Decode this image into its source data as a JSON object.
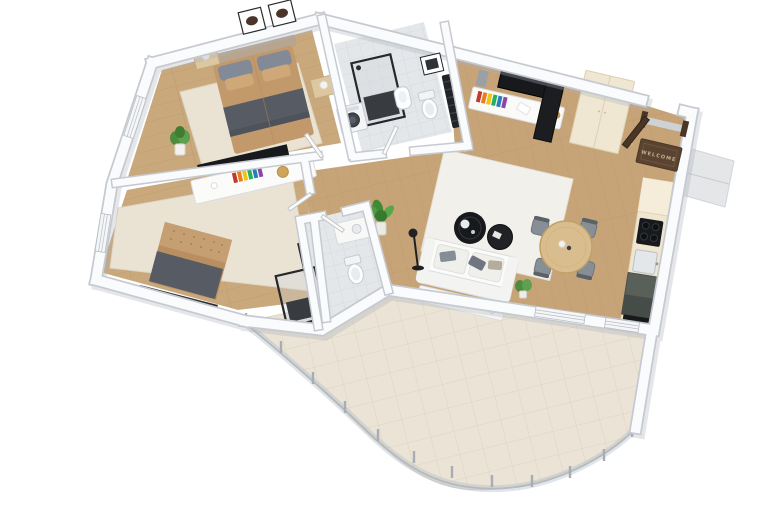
{
  "image": {
    "type": "3d-floor-plan-rendering",
    "view": "isometric top-down",
    "background": "#ffffff"
  },
  "palette": {
    "wood": "#c9a87c",
    "wood_living": "#c7a478",
    "wall": "#fafbfc",
    "wall_edge": "#c6cad0",
    "tile_bath": "#e4e7e9",
    "tile_terrace": "#ebe4d6",
    "rug": "#eae3d4",
    "bed_tan": "#c2996b",
    "blanket": "#565b64",
    "kitchen_dark": "#59605a",
    "cabinet_cream": "#efe7d2",
    "door_brown": "#4a3627",
    "plant": "#4f9c42",
    "black": "#17191c"
  },
  "entry": {
    "doormat_text": "WELCOME",
    "door": "dark-brown-entry-door-open",
    "landing": "exterior-step-landing"
  },
  "decor": {
    "book_spines": [
      "#c0392b",
      "#e67e22",
      "#f1c40f",
      "#27ae60",
      "#2980b9",
      "#8e44ad"
    ]
  },
  "rooms": [
    {
      "id": "bedroom-1",
      "floor": "light-wood-with-cream-rug",
      "furniture": [
        "double-bed-tan-duvet",
        "dark-gray-throw",
        "gray-and-tan-pillows",
        "upholstered-headboard",
        "nightstand-left-with-lamp",
        "nightstand-right-with-lamp",
        "two-framed-artworks",
        "potted-plant"
      ]
    },
    {
      "id": "bedroom-2",
      "floor": "light-wood-with-cream-rug",
      "furniture": [
        "tufted-bed-tan",
        "dark-gray-throw",
        "foot-bench",
        "white-sideboard",
        "potted-plant"
      ]
    },
    {
      "id": "bathroom-1",
      "floor": "gray-tile",
      "furniture": [
        "black-frame-walk-in-shower",
        "washing-machine",
        "wall-hung-bidet",
        "toilet",
        "black-towel-radiator",
        "framed-artwork"
      ]
    },
    {
      "id": "hallway",
      "floor": "light-wood",
      "furniture": [
        "potted-plant",
        "open-white-doors"
      ]
    },
    {
      "id": "bathroom-2",
      "floor": "gray-tile",
      "furniture": [
        "black-frame-walk-in-shower",
        "toilet",
        "vanity-unit",
        "black-wall-shelf"
      ]
    },
    {
      "id": "living-dining-kitchen",
      "floor": "wood-planks",
      "furniture": [
        "media-console-with-colorful-books",
        "wall-tv",
        "black-cabinet",
        "tall-cream-wardrobe",
        "white-sofa-with-pillows",
        "white-console-with-candles",
        "small-plant",
        "black-floor-lamp",
        "round-black-coffee-table-large",
        "round-black-coffee-table-small",
        "white-rug",
        "round-wood-dining-table",
        "dining-chair-x4",
        "kitchen-counter-run",
        "black-cooktop",
        "sink",
        "dark-base-cabinets",
        "doormat"
      ]
    },
    {
      "id": "terrace",
      "floor": "beige-tile",
      "furniture": [
        "curved-glass-railing",
        "railing-posts-x12",
        "low-white-wall"
      ],
      "railing_posts_count": 12
    }
  ]
}
